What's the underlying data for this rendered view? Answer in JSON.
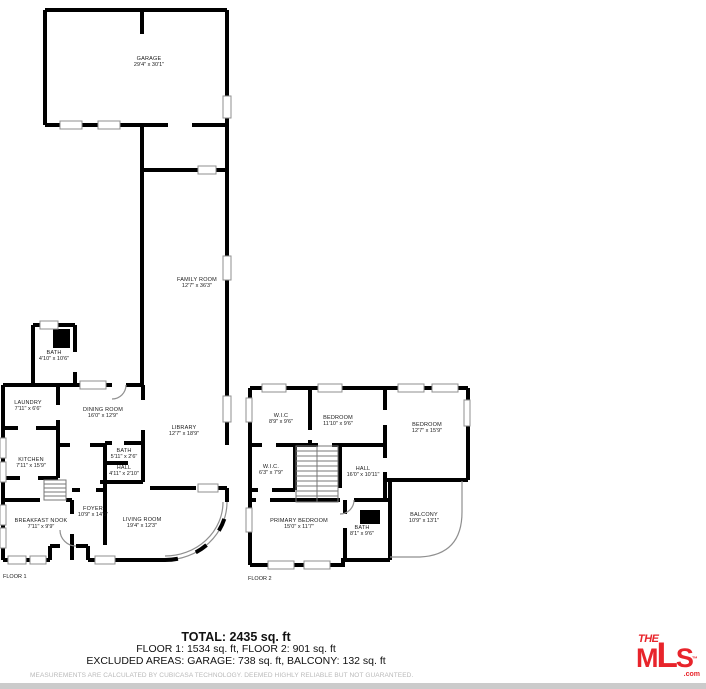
{
  "floor1": {
    "label": "FLOOR 1",
    "rooms": [
      {
        "name": "GARAGE",
        "dims": "29'4\" x 30'1\""
      },
      {
        "name": "FAMILY ROOM",
        "dims": "12'7\" x 36'3\""
      },
      {
        "name": "BATH",
        "dims": "4'10\" x 10'6\""
      },
      {
        "name": "LAUNDRY",
        "dims": "7'11\" x 6'6\""
      },
      {
        "name": "DINING ROOM",
        "dims": "16'0\" x 12'9\""
      },
      {
        "name": "KITCHEN",
        "dims": "7'11\" x 15'9\""
      },
      {
        "name": "LIBRARY",
        "dims": "12'7\" x 18'9\""
      },
      {
        "name": "BATH",
        "dims": "5'11\" x 2'6\""
      },
      {
        "name": "HALL",
        "dims": "4'11\" x 2'10\""
      },
      {
        "name": "BREAKFAST NOOK",
        "dims": "7'11\" x 9'9\""
      },
      {
        "name": "FOYER",
        "dims": "10'9\" x 14'0\""
      },
      {
        "name": "LIVING ROOM",
        "dims": "19'4\" x 12'3\""
      }
    ]
  },
  "floor2": {
    "label": "FLOOR 2",
    "rooms": [
      {
        "name": "W.I.C",
        "dims": "8'9\" x 9'6\""
      },
      {
        "name": "BEDROOM",
        "dims": "11'10\" x 9'6\""
      },
      {
        "name": "BEDROOM",
        "dims": "12'7\" x 15'9\""
      },
      {
        "name": "W.I.C.",
        "dims": "6'3\" x 7'9\""
      },
      {
        "name": "HALL",
        "dims": "16'0\" x 10'11\""
      },
      {
        "name": "PRIMARY BEDROOM",
        "dims": "15'0\" x 11'7\""
      },
      {
        "name": "BATH",
        "dims": "8'1\" x 9'6\""
      },
      {
        "name": "BALCONY",
        "dims": "10'9\" x 13'1\""
      }
    ]
  },
  "summary": {
    "total": "TOTAL: 2435 sq. ft",
    "floors": "FLOOR 1: 1534 sq. ft, FLOOR 2: 901 sq. ft",
    "excluded": "EXCLUDED AREAS: GARAGE: 738 sq. ft, BALCONY: 132 sq. ft"
  },
  "disclaimer": "MEASUREMENTS ARE CALCULATED BY CUBICASA TECHNOLOGY. DEEMED HIGHLY RELIABLE BUT NOT GUARANTEED.",
  "branding": {
    "the": "THE",
    "mls": "MLS",
    "tm": "™",
    "com": ".com"
  },
  "colors": {
    "wall": "#000000",
    "window_outline": "#8f8f8f",
    "accent_red": "#e8242b",
    "disclaimer_gray": "#b9b9b9",
    "footer_bar": "#cbcbcb"
  }
}
